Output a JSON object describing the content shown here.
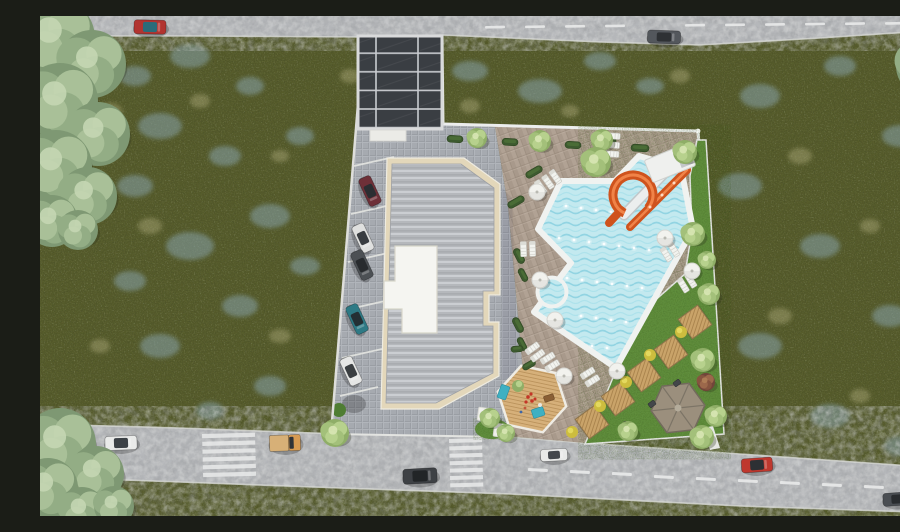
{
  "scene": {
    "title": "Aerial 3D render — residential site plan",
    "description": "Top-down architectural rendering: apartment block with ribbed grey roof and white rooftop terrace, solar-panel carport, angled parking with five cars, free-form swimming pool with orange spiral water slide and kiddie pool, sun loungers and parasols, lawn with timber seating decks and hexagonal gazebo, kids deck, wildflower meadow all around, and two roads with vehicles at top and bottom."
  },
  "palette": {
    "meadow": "#5c6130",
    "meadow_flowers": "#8ba8b4",
    "meadow_pale": "#d6cf9f",
    "road": "#b5b7ba",
    "road_marking": "#e9eaea",
    "paving_grey": "#a6aab0",
    "paving_brown": "#a8998b",
    "building_trim": "#e3d7ba",
    "roof": "#b5b8bc",
    "rooftop_terrace": "#f5f5f1",
    "solar_panel": "#3a3e43",
    "solar_frame": "#d9dadb",
    "pool_water": "#c3e9ef",
    "pool_rim": "#f0f2f0",
    "slide_orange": "#cf531d",
    "lawn": "#618e3e",
    "hedge": "#3d5a2f",
    "timber": "#c9a369",
    "gazebo_roof": "#9b8f7d",
    "parasol": "#f2f2ee",
    "yellow_bush": "#cdbd3e",
    "tree_sage": [
      "#7e9873",
      "#93ad85",
      "#a9c098",
      "#c4d6b3"
    ],
    "tree_lush": [
      "#8fae67",
      "#a3c07a",
      "#b7d18d",
      "#d8e6b4"
    ],
    "tree_red": [
      "#71453a",
      "#86543f",
      "#9c684b",
      "#b07f58"
    ]
  },
  "counts": {
    "parked_cars": 5,
    "road_vehicles": 8,
    "parasols": 7,
    "lounger_groups": 8,
    "timber_decks": 5,
    "crosswalks": 2
  },
  "objects": {
    "flower_patches": [
      [
        95,
        60,
        16,
        10
      ],
      [
        150,
        40,
        20,
        12
      ],
      [
        210,
        70,
        14,
        9
      ],
      [
        120,
        110,
        22,
        13
      ],
      [
        185,
        140,
        16,
        10
      ],
      [
        95,
        170,
        18,
        11
      ],
      [
        230,
        200,
        20,
        12
      ],
      [
        150,
        230,
        24,
        14
      ],
      [
        90,
        265,
        16,
        10
      ],
      [
        200,
        290,
        18,
        11
      ],
      [
        120,
        330,
        20,
        12
      ],
      [
        230,
        370,
        16,
        10
      ],
      [
        170,
        395,
        14,
        9
      ],
      [
        430,
        55,
        18,
        10
      ],
      [
        500,
        75,
        22,
        12
      ],
      [
        560,
        45,
        16,
        9
      ],
      [
        610,
        70,
        14,
        8
      ],
      [
        720,
        80,
        20,
        12
      ],
      [
        800,
        50,
        16,
        10
      ],
      [
        860,
        120,
        18,
        11
      ],
      [
        700,
        170,
        22,
        13
      ],
      [
        780,
        230,
        20,
        12
      ],
      [
        850,
        300,
        18,
        11
      ],
      [
        720,
        330,
        22,
        13
      ],
      [
        790,
        400,
        20,
        12
      ],
      [
        860,
        430,
        16,
        10
      ],
      [
        700,
        470,
        18,
        10
      ],
      [
        260,
        120,
        14,
        9
      ],
      [
        265,
        250,
        15,
        9
      ]
    ],
    "pale_patches": [
      [
        70,
        95,
        12,
        8
      ],
      [
        160,
        85,
        10,
        7
      ],
      [
        110,
        210,
        12,
        8
      ],
      [
        60,
        330,
        10,
        7
      ],
      [
        240,
        140,
        9,
        6
      ],
      [
        310,
        60,
        10,
        7
      ],
      [
        430,
        90,
        10,
        7
      ],
      [
        530,
        95,
        9,
        6
      ],
      [
        640,
        60,
        10,
        7
      ],
      [
        760,
        140,
        12,
        8
      ],
      [
        830,
        210,
        10,
        7
      ],
      [
        740,
        300,
        12,
        8
      ],
      [
        820,
        380,
        10,
        7
      ],
      [
        240,
        320,
        11,
        7
      ]
    ],
    "trees_sage": [
      [
        15,
        22,
        40
      ],
      [
        52,
        48,
        34
      ],
      [
        20,
        85,
        38
      ],
      [
        58,
        118,
        32
      ],
      [
        16,
        150,
        36
      ],
      [
        48,
        180,
        29
      ],
      [
        12,
        205,
        26
      ],
      [
        38,
        214,
        20
      ],
      [
        20,
        428,
        36
      ],
      [
        56,
        458,
        28
      ],
      [
        8,
        472,
        30
      ],
      [
        42,
        495,
        24
      ],
      [
        74,
        490,
        20
      ],
      [
        886,
        50,
        30
      ],
      [
        899,
        84,
        20
      ]
    ],
    "trees_lush": [
      [
        437,
        122,
        10
      ],
      [
        500,
        125,
        11
      ],
      [
        562,
        124,
        11
      ],
      [
        645,
        136,
        12
      ],
      [
        556,
        146,
        15
      ],
      [
        653,
        218,
        12
      ],
      [
        667,
        244,
        9
      ],
      [
        669,
        278,
        11
      ],
      [
        663,
        344,
        12
      ],
      [
        676,
        400,
        11
      ],
      [
        588,
        415,
        10
      ],
      [
        450,
        402,
        10
      ],
      [
        466,
        417,
        9
      ],
      [
        295,
        417,
        14
      ],
      [
        662,
        421,
        12
      ]
    ],
    "trees_red": [
      [
        666,
        366,
        9
      ]
    ],
    "hedges": [
      [
        415,
        123,
        16,
        7,
        3
      ],
      [
        470,
        126,
        16,
        7,
        3
      ],
      [
        533,
        129,
        16,
        7,
        3
      ],
      [
        600,
        132,
        18,
        7,
        3
      ],
      [
        569,
        125,
        14,
        6,
        3
      ],
      [
        494,
        156,
        18,
        7,
        -30
      ],
      [
        476,
        186,
        18,
        7,
        -30
      ],
      [
        479,
        240,
        16,
        7,
        62
      ],
      [
        483,
        259,
        14,
        6,
        62
      ],
      [
        478,
        309,
        16,
        7,
        62
      ],
      [
        482,
        328,
        14,
        6,
        62
      ],
      [
        489,
        349,
        14,
        6,
        -30
      ],
      [
        477,
        333,
        12,
        6,
        -5
      ]
    ],
    "umbrellas": [
      [
        497,
        176
      ],
      [
        500,
        264
      ],
      [
        515,
        304
      ],
      [
        524,
        360
      ],
      [
        577,
        355
      ],
      [
        625,
        222
      ],
      [
        652,
        255
      ]
    ],
    "lounger_groups": [
      [
        508,
        166,
        55,
        3
      ],
      [
        572,
        129,
        4,
        3
      ],
      [
        488,
        233,
        88,
        2
      ],
      [
        495,
        336,
        -36,
        2
      ],
      [
        510,
        346,
        -32,
        2
      ],
      [
        550,
        361,
        -32,
        2
      ],
      [
        630,
        236,
        58,
        2
      ],
      [
        647,
        267,
        58,
        2
      ]
    ],
    "wood_decks": [
      [
        655,
        306
      ],
      [
        631,
        336
      ],
      [
        604,
        359
      ],
      [
        578,
        383
      ],
      [
        552,
        406
      ]
    ],
    "yellow_bushes": [
      [
        641,
        316
      ],
      [
        610,
        339
      ],
      [
        586,
        366
      ],
      [
        560,
        390
      ],
      [
        532,
        416
      ]
    ],
    "grills": [
      [
        637,
        367
      ],
      [
        612,
        388
      ],
      [
        584,
        409
      ]
    ],
    "pool_lights": [
      [
        526,
        190
      ],
      [
        541,
        192
      ],
      [
        556,
        194
      ],
      [
        571,
        196
      ],
      [
        519,
        222
      ],
      [
        534,
        224
      ],
      [
        549,
        226
      ],
      [
        564,
        228
      ],
      [
        579,
        230
      ],
      [
        594,
        232
      ],
      [
        609,
        234
      ],
      [
        527,
        262
      ],
      [
        542,
        264
      ],
      [
        557,
        266
      ],
      [
        572,
        268
      ],
      [
        587,
        270
      ],
      [
        602,
        272
      ],
      [
        541,
        300
      ],
      [
        556,
        302
      ],
      [
        571,
        304
      ],
      [
        586,
        306
      ],
      [
        552,
        330
      ],
      [
        567,
        332
      ],
      [
        596,
        160
      ],
      [
        610,
        166
      ],
      [
        623,
        176
      ]
    ],
    "dashes_top": [
      [
        445,
        10
      ],
      [
        485,
        9.6
      ],
      [
        525,
        9.2
      ],
      [
        565,
        8.8
      ],
      [
        645,
        8.1
      ],
      [
        685,
        7.7
      ],
      [
        725,
        7.3
      ],
      [
        765,
        6.9
      ],
      [
        805,
        6.5
      ],
      [
        845,
        6.2
      ],
      [
        883,
        5.9
      ]
    ],
    "dashes_bottom": [
      [
        488,
        452
      ],
      [
        530,
        454
      ],
      [
        572,
        456
      ],
      [
        614,
        459
      ],
      [
        656,
        461
      ],
      [
        698,
        463
      ],
      [
        740,
        465
      ],
      [
        782,
        467
      ],
      [
        824,
        469
      ],
      [
        866,
        471
      ]
    ],
    "crosswalks": [
      {
        "x": 162,
        "y": 418,
        "w": 53,
        "h": 4.2,
        "step": 7.8,
        "n": 6
      },
      {
        "x": 409,
        "y": 423,
        "w": 33,
        "h": 4,
        "step": 7.4,
        "n": 7
      }
    ],
    "cars_road": [
      {
        "x": 110,
        "y": 11,
        "rot": 1,
        "w": 32,
        "h": 14,
        "body": "#b23430",
        "glass": "#2a6c7a"
      },
      {
        "x": 624,
        "y": 21,
        "rot": 2,
        "w": 33,
        "h": 13,
        "body": "#53575c",
        "glass": "#2e3134"
      },
      {
        "x": 81,
        "y": 427,
        "rot": -2,
        "w": 32,
        "h": 14,
        "body": "#e9eae9",
        "glass": "#3c4146"
      },
      {
        "x": 245,
        "y": 427,
        "rot": -2,
        "w": 31,
        "h": 16,
        "body": "#d79b52",
        "glass": "#2f3337",
        "type": "truck"
      },
      {
        "x": 380,
        "y": 460,
        "rot": -3,
        "w": 34,
        "h": 15,
        "body": "#3e4145",
        "glass": "#222527"
      },
      {
        "x": 514,
        "y": 439,
        "rot": -3,
        "w": 27,
        "h": 12,
        "body": "#e8e9e8",
        "glass": "#43474c"
      },
      {
        "x": 717,
        "y": 449,
        "rot": -4,
        "w": 31,
        "h": 14,
        "body": "#bf382e",
        "glass": "#2d3034"
      },
      {
        "x": 858,
        "y": 483,
        "rot": -4,
        "w": 30,
        "h": 13,
        "body": "#4a4e53",
        "glass": "#292c2f"
      }
    ],
    "cars_parked": [
      {
        "x": 330,
        "y": 175,
        "rot": 65,
        "w": 30,
        "h": 13,
        "body": "#6e3038",
        "glass": "#2b2e32"
      },
      {
        "x": 323,
        "y": 222,
        "rot": 65,
        "w": 29,
        "h": 13,
        "body": "#dfe0df",
        "glass": "#393d41"
      },
      {
        "x": 322,
        "y": 249,
        "rot": 65,
        "w": 30,
        "h": 13,
        "body": "#4c5054",
        "glass": "#282b2e"
      },
      {
        "x": 317,
        "y": 303,
        "rot": 65,
        "w": 30,
        "h": 13,
        "body": "#2e7a85",
        "glass": "#243034"
      },
      {
        "x": 311,
        "y": 355,
        "rot": 65,
        "w": 29,
        "h": 13,
        "body": "#e5e6e5",
        "glass": "#3b3f42"
      }
    ],
    "platforms": [
      {
        "x": 492,
        "y": 383,
        "r": 35,
        "sides": 6,
        "rot": 12,
        "kind": "kids-deck"
      },
      {
        "x": 638,
        "y": 392,
        "r": 27,
        "sides": 6,
        "rot": -6,
        "kind": "gazebo"
      }
    ]
  }
}
